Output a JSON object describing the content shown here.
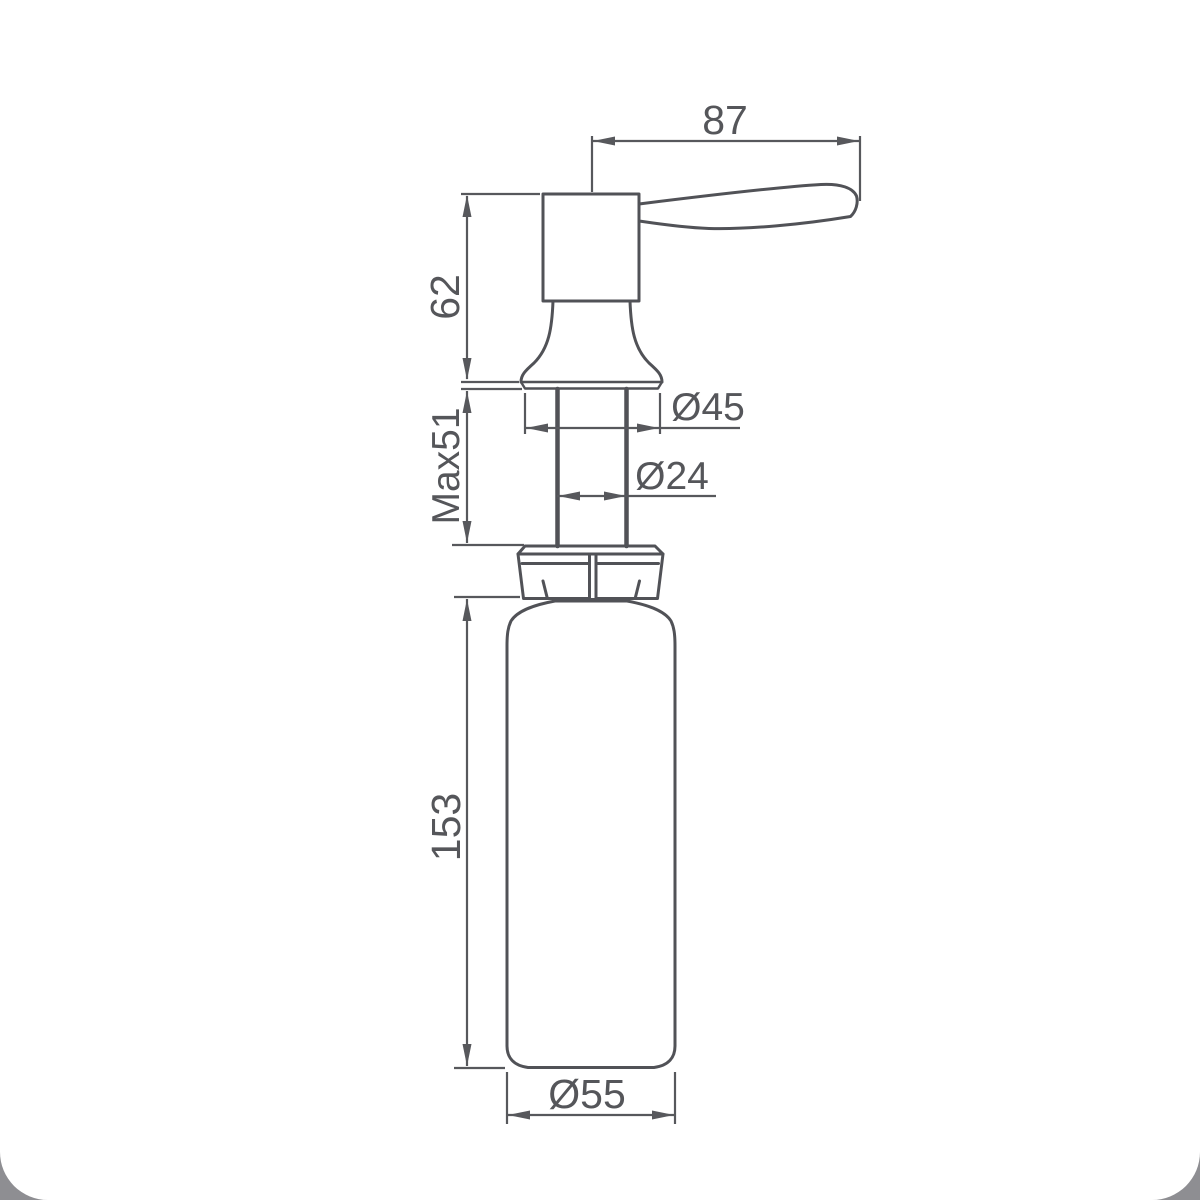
{
  "colors": {
    "background": "#8e8e92",
    "canvas": "#ffffff",
    "object_line": "#515257",
    "dimension_line": "#57585c",
    "label_text": "#55565a"
  },
  "drawing": {
    "dimensions": {
      "spout_length": "87",
      "pump_height": "62",
      "max_mount_thickness": "Max51",
      "flange_diameter": "Ø45",
      "tube_diameter": "Ø24",
      "bottle_height": "153",
      "bottle_diameter": "Ø55"
    }
  }
}
